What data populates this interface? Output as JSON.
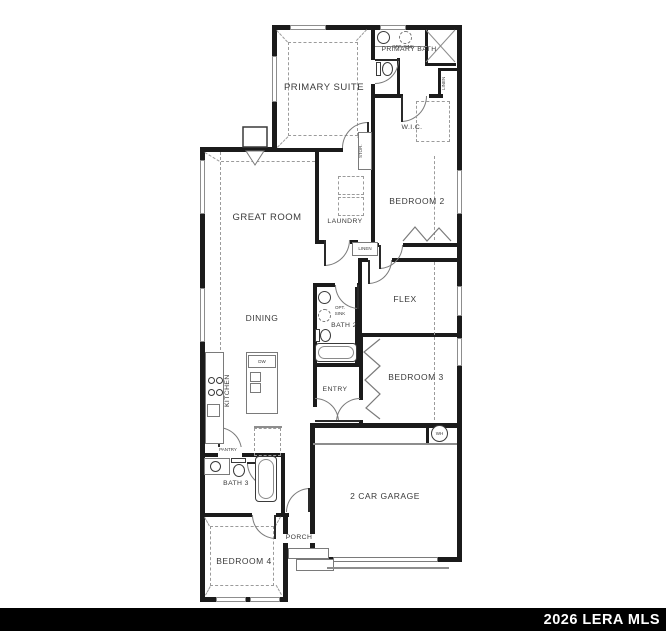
{
  "watermark": {
    "text": "2026 LERA MLS"
  },
  "rooms": {
    "primary_suite": "PRIMARY SUITE",
    "primary_bath": "PRIMARY BATH",
    "wic": "W.I.C.",
    "great_room": "GREAT ROOM",
    "laundry": "LAUNDRY",
    "bedroom_2": "BEDROOM 2",
    "flex": "FLEX",
    "dining": "DINING",
    "kitchen": "KITCHEN",
    "bath_2": "BATH 2",
    "entry": "ENTRY",
    "bedroom_3": "BEDROOM 3",
    "garage": "2 CAR GARAGE",
    "pantry": "PANTRY",
    "bath_3": "BATH 3",
    "porch": "PORCH",
    "bedroom_4": "BEDROOM 4"
  },
  "closets": {
    "linen_primary": "LINEN",
    "linen_hall": "LINEN",
    "storage": "STOR."
  },
  "fixtures": {
    "dishwasher": "DW",
    "water_heater": "WH",
    "optional_sink_primary": "OPT. SINK",
    "optional_sink_bath2": "OPT. SINK"
  },
  "colors": {
    "wall": "#1b1b1b",
    "thin_line": "#8d8d8d",
    "label": "#3a3a3a",
    "watermark_bar": "#000000",
    "watermark_text": "#ffffff",
    "background": "#ffffff"
  }
}
